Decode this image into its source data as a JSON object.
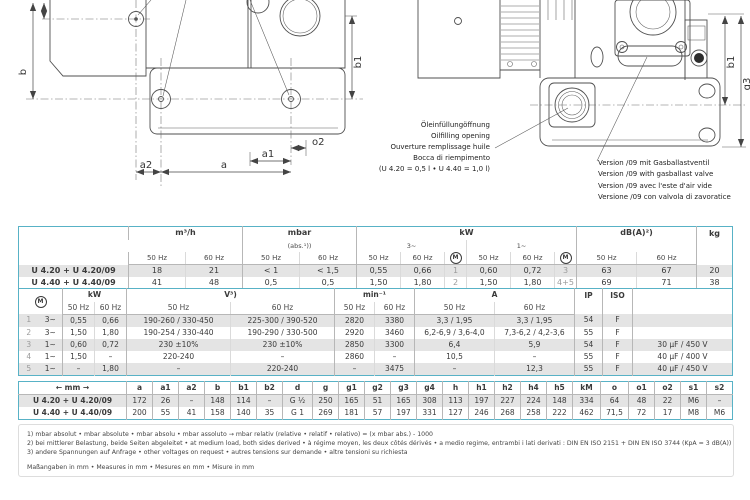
{
  "drawing": {
    "dims": {
      "b": "b",
      "b1": "b1",
      "a": "a",
      "a1": "a1",
      "a2": "a2",
      "o2": "o2",
      "g3": "g3"
    },
    "oil_note": [
      "Öleinfüllungöffnung",
      "Oilfilling opening",
      "Ouverture remplissage huile",
      "Bocca di riempimento",
      "(U 4.20 = 0,5 l • U 4.40 = 1,0 l)"
    ],
    "version_note": [
      "Version /09 mit Gasballastventil",
      "Version /09 with gasballast valve",
      "Version /09 avec l'este d'air vide",
      "Versione /09 con valvola di zavoratice"
    ]
  },
  "units": {
    "hz50": "50 Hz",
    "hz60": "60 Hz"
  },
  "t1": {
    "groups": {
      "m3h": "m³/h",
      "mbar": "mbar",
      "mbar_sub": "(abs.¹))",
      "kw": "kW",
      "p3": "3~",
      "p1": "1~",
      "dba": "dB(A)²)",
      "kg": "kg",
      "m": "M"
    },
    "rows": [
      {
        "model": "U 4.20 + U 4.20/09",
        "cells": [
          "18",
          "21",
          "< 1",
          "< 1,5",
          "0,55",
          "0,66",
          "1",
          "0,60",
          "0,72",
          "3",
          "63",
          "67",
          "20"
        ]
      },
      {
        "model": "U 4.40 + U 4.40/09",
        "cells": [
          "41",
          "48",
          "0,5",
          "0,5",
          "1,50",
          "1,80",
          "2",
          "1,50",
          "1,80",
          "4+5",
          "69",
          "71",
          "38"
        ]
      }
    ]
  },
  "t2": {
    "groups": {
      "m": "M",
      "kw": "kW",
      "v": "V³)",
      "min": "min⁻¹",
      "a": "A",
      "ip": "IP",
      "iso": "ISO"
    },
    "rows": [
      {
        "num": "1",
        "phase": "3~",
        "cells": [
          "0,55",
          "0,66",
          "190-260 / 330-450",
          "225-300 / 390-520",
          "2820",
          "3380",
          "3,3 / 1,95",
          "3,3 / 1,95",
          "54",
          "F",
          ""
        ]
      },
      {
        "num": "2",
        "phase": "3~",
        "cells": [
          "1,50",
          "1,80",
          "190-254 / 330-440",
          "190-290 / 330-500",
          "2920",
          "3460",
          "6,2-6,9 / 3,6-4,0",
          "7,3-6,2 / 4,2-3,6",
          "55",
          "F",
          ""
        ]
      },
      {
        "num": "3",
        "phase": "1~",
        "cells": [
          "0,60",
          "0,72",
          "230 ±10%",
          "230 ±10%",
          "2850",
          "3300",
          "6,4",
          "5,9",
          "54",
          "F",
          "30 µF / 450 V"
        ]
      },
      {
        "num": "4",
        "phase": "1~",
        "cells": [
          "1,50",
          "–",
          "220-240",
          "–",
          "2860",
          "–",
          "10,5",
          "–",
          "55",
          "F",
          "40 µF / 400 V"
        ]
      },
      {
        "num": "5",
        "phase": "1~",
        "cells": [
          "–",
          "1,80",
          "–",
          "220-240",
          "–",
          "3475",
          "–",
          "12,3",
          "55",
          "F",
          "40 µF / 450 V"
        ]
      }
    ]
  },
  "t3": {
    "mm": "← mm →",
    "headers": [
      "a",
      "a1",
      "a2",
      "b",
      "b1",
      "b2",
      "d",
      "g",
      "g1",
      "g2",
      "g3",
      "g4",
      "h",
      "h1",
      "h2",
      "h4",
      "h5",
      "kM",
      "o",
      "o1",
      "o2",
      "s1",
      "s2"
    ],
    "rows": [
      {
        "model": "U 4.20 + U 4.20/09",
        "cells": [
          "172",
          "26",
          "–",
          "148",
          "114",
          "–",
          "G ½",
          "250",
          "165",
          "51",
          "165",
          "308",
          "113",
          "197",
          "227",
          "224",
          "148",
          "334",
          "64",
          "48",
          "22",
          "M6",
          "–"
        ]
      },
      {
        "model": "U 4.40 + U 4.40/09",
        "cells": [
          "200",
          "55",
          "41",
          "158",
          "140",
          "35",
          "G 1",
          "269",
          "181",
          "57",
          "197",
          "331",
          "127",
          "246",
          "268",
          "258",
          "222",
          "462",
          "71,5",
          "72",
          "17",
          "M8",
          "M6"
        ]
      }
    ]
  },
  "notes": {
    "fn1": "1) mbar absolut • mbar absolute • mbar absolu • mbar assoluto  →  mbar relativ (relative • relatif • relativo) = (x mbar abs.) - 1000",
    "fn2": "2) bei mittlerer Belastung, beide Seiten abgeleitet • at medium load, both sides derived • à régime moyen, les deux côtés dérivés • a medio regime, entrambi i lati derivati :  DIN EN ISO 2151 + DIN EN ISO 3744 (KpA = 3 dB(A))",
    "fn3": "3) andere Spannungen auf Anfrage • other voltages on request • autres tensions sur demande • altre tensioni su richiesta",
    "mm": "Maßangaben in mm • Measures in mm • Mesures en mm • Misure in mm"
  }
}
